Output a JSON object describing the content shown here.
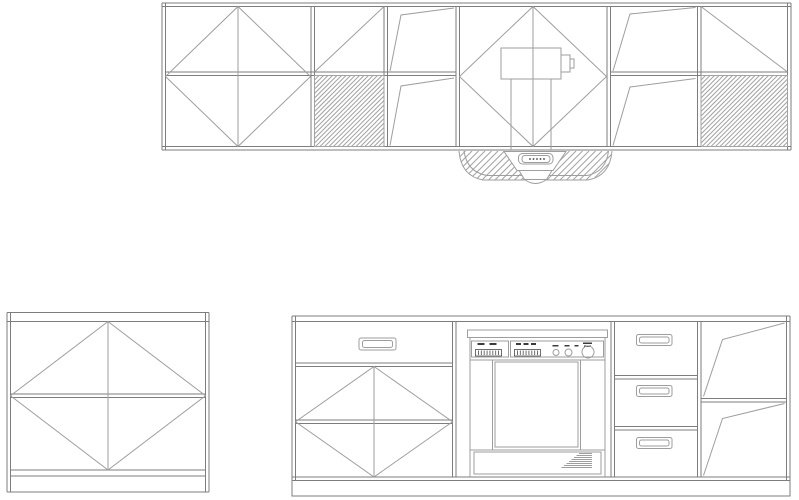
{
  "canvas": {
    "width": 799,
    "height": 500,
    "background": "#ffffff"
  },
  "colors": {
    "frame": "#7d7d7d",
    "line": "#9e9e9e",
    "hatch": "#a3a3a3",
    "dark": "#3c3c3c",
    "white": "#ffffff",
    "none": "none"
  },
  "drawings": [
    {
      "name": "wall-cabinet-run",
      "primitives": [
        {
          "t": "dline",
          "x1": 162,
          "y1": 3,
          "x2": 791,
          "y2": 3,
          "g": 3.5,
          "c": "frame"
        },
        {
          "t": "dline",
          "x1": 162,
          "y1": 146.5,
          "x2": 791,
          "y2": 146.5,
          "g": 3.5,
          "c": "frame"
        },
        {
          "t": "dline",
          "x1": 162,
          "y1": 3,
          "x2": 162,
          "y2": 150,
          "g": 3.5,
          "c": "frame"
        },
        {
          "t": "dline",
          "x1": 787.5,
          "y1": 3,
          "x2": 787.5,
          "y2": 150,
          "g": 3.5,
          "c": "frame"
        },
        {
          "t": "dline",
          "x1": 311,
          "y1": 6.5,
          "x2": 311,
          "y2": 146.5,
          "g": 3.5,
          "c": "frame",
          "name": "partition"
        },
        {
          "t": "dline",
          "x1": 384,
          "y1": 6.5,
          "x2": 384,
          "y2": 146.5,
          "g": 3.5,
          "c": "frame",
          "name": "partition"
        },
        {
          "t": "dline",
          "x1": 456,
          "y1": 6.5,
          "x2": 456,
          "y2": 146.5,
          "g": 3.5,
          "c": "frame",
          "name": "partition"
        },
        {
          "t": "dline",
          "x1": 607,
          "y1": 6.5,
          "x2": 607,
          "y2": 146.5,
          "g": 3.5,
          "c": "frame",
          "name": "partition"
        },
        {
          "t": "dline",
          "x1": 697.5,
          "y1": 6.5,
          "x2": 697.5,
          "y2": 146.5,
          "g": 3.5,
          "c": "frame",
          "name": "partition"
        },
        {
          "t": "dline",
          "x1": 165.5,
          "y1": 72,
          "x2": 456,
          "y2": 72,
          "g": 3.5,
          "c": "frame",
          "name": "mid-rail"
        },
        {
          "t": "dline",
          "x1": 610.5,
          "y1": 72,
          "x2": 787.5,
          "y2": 72,
          "g": 3.5,
          "c": "frame",
          "name": "mid-rail"
        },
        {
          "t": "diamond",
          "cx": 238,
          "cy": 76.5,
          "rx": 72.5,
          "ry": 70,
          "vline": true,
          "name": "door-diamond-symbol"
        },
        {
          "t": "line",
          "x1": 314.5,
          "y1": 72,
          "x2": 384,
          "y2": 6.5,
          "name": "door-diagonal-symbol"
        },
        {
          "t": "hatch",
          "x": 314.5,
          "y": 75.5,
          "w": 69.5,
          "h": 71,
          "s": 4.5,
          "name": "hatched-panel"
        },
        {
          "t": "poly",
          "pts": [
            [
              390,
              71
            ],
            [
              401,
              15
            ],
            [
              454,
              8
            ]
          ],
          "name": "door-swing-symbol"
        },
        {
          "t": "poly",
          "pts": [
            [
              390,
              145.5
            ],
            [
              401,
              86
            ],
            [
              454,
              78
            ]
          ],
          "name": "door-swing-symbol"
        },
        {
          "t": "diamond",
          "cx": 533,
          "cy": 76.5,
          "rx": 73.5,
          "ry": 70,
          "vline": true,
          "name": "door-diamond-symbol"
        },
        {
          "t": "rect",
          "x": 501,
          "y": 48,
          "w": 60,
          "h": 31,
          "name": "fan-unit"
        },
        {
          "t": "rect",
          "x": 561,
          "y": 55,
          "w": 9,
          "h": 17,
          "name": "fan-motor"
        },
        {
          "t": "rect",
          "x": 570,
          "y": 59,
          "w": 4,
          "h": 9
        },
        {
          "t": "line",
          "x1": 511,
          "y1": 79,
          "x2": 511,
          "y2": 150,
          "name": "duct-line"
        },
        {
          "t": "line",
          "x1": 551,
          "y1": 79,
          "x2": 551,
          "y2": 150,
          "name": "duct-line"
        },
        {
          "t": "poly",
          "pts": [
            [
              613,
              71
            ],
            [
              630,
              14
            ],
            [
              695.5,
              7.5
            ]
          ],
          "name": "door-swing-symbol"
        },
        {
          "t": "poly",
          "pts": [
            [
              613,
              145.5
            ],
            [
              630,
              87
            ],
            [
              695.5,
              78.5
            ]
          ],
          "name": "door-swing-symbol"
        },
        {
          "t": "line",
          "x1": 701,
          "y1": 6.5,
          "x2": 787.5,
          "y2": 72,
          "name": "door-diagonal-symbol"
        },
        {
          "t": "hatch",
          "x": 701,
          "y": 75.5,
          "w": 86.5,
          "h": 71,
          "s": 4.5,
          "name": "hatched-panel"
        }
      ]
    },
    {
      "name": "range-hood",
      "primitives": [
        {
          "t": "path",
          "d": "M 459 151 Q 461 176 483 180 L 588 180 Q 610 176 612 151",
          "f": "none",
          "name": "hood-outline"
        },
        {
          "t": "hatch",
          "x": 459,
          "y": 151,
          "w": 153,
          "h": 30,
          "s": 6.5,
          "clipd": "M 459 151 Q 461 176 483 180 L 588 180 Q 610 176 612 151 Z",
          "name": "hood-hatch"
        },
        {
          "t": "path",
          "d": "M 464 151 Q 467 172 487 175.5 L 587 175.5 Q 606 172 608.5 151",
          "f": "none"
        },
        {
          "t": "polygon",
          "pts": [
            [
              504,
              151.5
            ],
            [
              566,
              151.5
            ],
            [
              553,
              170.5
            ],
            [
              517,
              170.5
            ]
          ],
          "f": "white",
          "name": "hood-control-panel"
        },
        {
          "t": "rrect",
          "x": 518.5,
          "y": 153.5,
          "w": 34.5,
          "h": 10.5,
          "rx": 4,
          "f": "white",
          "name": "hood-control-pad"
        },
        {
          "t": "rrect",
          "x": 522,
          "y": 155.5,
          "w": 28,
          "h": 7,
          "rx": 3,
          "f": "white"
        },
        {
          "t": "dot",
          "x": 530,
          "y": 159,
          "r": 0.9,
          "name": "hood-button"
        },
        {
          "t": "dot",
          "x": 533.5,
          "y": 159,
          "r": 0.9,
          "name": "hood-button"
        },
        {
          "t": "dot",
          "x": 537,
          "y": 159,
          "r": 0.9,
          "name": "hood-button"
        },
        {
          "t": "dot",
          "x": 540.5,
          "y": 159,
          "r": 0.9,
          "name": "hood-button"
        },
        {
          "t": "dot",
          "x": 544,
          "y": 159,
          "r": 0.9,
          "name": "hood-button"
        },
        {
          "t": "polygon",
          "pts": [
            [
              519,
              170.5
            ],
            [
              552,
              170.5
            ],
            [
              546.5,
              179.5
            ],
            [
              524.5,
              179.5
            ]
          ],
          "f": "white",
          "name": "hood-lamp"
        },
        {
          "t": "path",
          "d": "M 524.5 179.5 Q 535.5 187.5 546.5 179.5 Z",
          "f": "white"
        }
      ]
    },
    {
      "name": "base-cabinet-single",
      "primitives": [
        {
          "t": "dline",
          "x1": 7,
          "y1": 312.5,
          "x2": 7,
          "y2": 492,
          "g": 3.5,
          "c": "frame"
        },
        {
          "t": "dline",
          "x1": 205.5,
          "y1": 312.5,
          "x2": 205.5,
          "y2": 492,
          "g": 3.5,
          "c": "frame"
        },
        {
          "t": "dline",
          "x1": 7,
          "y1": 312.5,
          "x2": 209,
          "y2": 312.5,
          "g": 9,
          "c": "frame",
          "name": "top-rail"
        },
        {
          "t": "dline",
          "x1": 10.5,
          "y1": 394,
          "x2": 205.5,
          "y2": 394,
          "g": 3.5,
          "c": "frame",
          "name": "mid-rail"
        },
        {
          "t": "dline",
          "x1": 10.5,
          "y1": 470,
          "x2": 205.5,
          "y2": 470,
          "g": 6,
          "c": "frame",
          "name": "bottom-rail"
        },
        {
          "t": "line",
          "x1": 7,
          "y1": 492,
          "x2": 209,
          "y2": 492,
          "c": "frame",
          "name": "plinth-line"
        },
        {
          "t": "diamond",
          "cx": 108,
          "cy": 395.75,
          "rx": 97.5,
          "ry": 74.25,
          "vline": true,
          "name": "door-diamond-symbol"
        }
      ]
    },
    {
      "name": "base-cabinet-run",
      "primitives": [
        {
          "t": "dline",
          "x1": 292,
          "y1": 316,
          "x2": 790,
          "y2": 316,
          "g": 5.5,
          "c": "frame",
          "name": "top-rail"
        },
        {
          "t": "dline",
          "x1": 292,
          "y1": 477,
          "x2": 790,
          "y2": 477,
          "g": 3.5,
          "c": "frame",
          "name": "bottom-rail"
        },
        {
          "t": "dline",
          "x1": 292,
          "y1": 316,
          "x2": 292,
          "y2": 480.5,
          "g": 3.5,
          "c": "frame"
        },
        {
          "t": "dline",
          "x1": 786.5,
          "y1": 316,
          "x2": 786.5,
          "y2": 480.5,
          "g": 3.5,
          "c": "frame"
        },
        {
          "t": "rect",
          "x": 292,
          "y": 480.5,
          "w": 498,
          "h": 15.5,
          "c": "frame",
          "name": "plinth"
        },
        {
          "t": "dline",
          "x1": 452.5,
          "y1": 321.5,
          "x2": 452.5,
          "y2": 477,
          "g": 3.5,
          "c": "frame",
          "name": "partition"
        },
        {
          "t": "dline",
          "x1": 611,
          "y1": 321.5,
          "x2": 611,
          "y2": 477,
          "g": 3.5,
          "c": "frame",
          "name": "partition"
        },
        {
          "t": "dline",
          "x1": 697.5,
          "y1": 321.5,
          "x2": 697.5,
          "y2": 477,
          "g": 3.5,
          "c": "frame",
          "name": "partition"
        },
        {
          "t": "dline",
          "x1": 295.5,
          "y1": 363,
          "x2": 452.5,
          "y2": 363,
          "g": 3.5,
          "c": "frame",
          "name": "drawer-rail"
        },
        {
          "t": "rrect",
          "x": 359,
          "y": 338,
          "w": 37,
          "h": 12,
          "rx": 2,
          "name": "drawer-handle"
        },
        {
          "t": "rrect",
          "x": 362.5,
          "y": 340.5,
          "w": 30,
          "h": 7,
          "rx": 2
        },
        {
          "t": "dline",
          "x1": 295.5,
          "y1": 420,
          "x2": 452.5,
          "y2": 420,
          "g": 3.5,
          "c": "frame",
          "name": "mid-rail"
        },
        {
          "t": "diamond",
          "cx": 374,
          "cy": 421.75,
          "rx": 78.5,
          "ry": 55.25,
          "vline": true,
          "name": "door-diamond-symbol"
        },
        {
          "t": "rect",
          "x": 467.5,
          "y": 330,
          "w": 140,
          "h": 7.5,
          "name": "dishwasher-trim"
        },
        {
          "t": "line",
          "x1": 470,
          "y1": 337.5,
          "x2": 470,
          "y2": 477,
          "name": "dishwasher-side"
        },
        {
          "t": "line",
          "x1": 605,
          "y1": 337.5,
          "x2": 605,
          "y2": 477,
          "name": "dishwasher-side"
        },
        {
          "t": "rect",
          "x": 471.5,
          "y": 341,
          "w": 37,
          "h": 16,
          "name": "dishwasher-control-left"
        },
        {
          "t": "rect",
          "x": 510.5,
          "y": 341,
          "w": 93,
          "h": 16,
          "name": "dishwasher-control-right"
        },
        {
          "t": "dash",
          "x": 477.5,
          "y": 343,
          "w": 7,
          "h": 2
        },
        {
          "t": "dash",
          "x": 489.5,
          "y": 343,
          "w": 7,
          "h": 2
        },
        {
          "t": "ticks",
          "x": 475.5,
          "y": 349.5,
          "w": 26,
          "h": 6.5,
          "n": 9,
          "name": "button-strip"
        },
        {
          "t": "dash",
          "x": 516,
          "y": 343,
          "w": 5,
          "h": 2
        },
        {
          "t": "dash",
          "x": 523.5,
          "y": 343,
          "w": 5,
          "h": 2
        },
        {
          "t": "dash",
          "x": 531,
          "y": 343,
          "w": 5,
          "h": 2
        },
        {
          "t": "ticks",
          "x": 514.5,
          "y": 349.5,
          "w": 26,
          "h": 6.5,
          "n": 9,
          "name": "button-strip"
        },
        {
          "t": "dash",
          "x": 552.5,
          "y": 345,
          "w": 6,
          "h": 1.5
        },
        {
          "t": "dash",
          "x": 564.5,
          "y": 345,
          "w": 5,
          "h": 1.5
        },
        {
          "t": "dash",
          "x": 574.5,
          "y": 345,
          "w": 4,
          "h": 1.5
        },
        {
          "t": "dash",
          "x": 583,
          "y": 342.5,
          "w": 9,
          "h": 1.5
        },
        {
          "t": "dash",
          "x": 584,
          "y": 345.5,
          "w": 7,
          "h": 1.5
        },
        {
          "t": "circle",
          "cx": 556,
          "cy": 352.5,
          "r": 3,
          "name": "dishwasher-knob"
        },
        {
          "t": "circle",
          "cx": 568.5,
          "cy": 352.5,
          "r": 3.5,
          "name": "dishwasher-knob"
        },
        {
          "t": "circle",
          "cx": 588,
          "cy": 352,
          "r": 6,
          "name": "dishwasher-dial"
        },
        {
          "t": "rect",
          "x": 470,
          "y": 360,
          "w": 135,
          "h": 90,
          "name": "dishwasher-door"
        },
        {
          "t": "line",
          "x1": 492.5,
          "y1": 360,
          "x2": 492.5,
          "y2": 450
        },
        {
          "t": "line",
          "x1": 580.5,
          "y1": 360,
          "x2": 580.5,
          "y2": 450
        },
        {
          "t": "rect",
          "x": 495,
          "y": 362,
          "w": 83,
          "h": 85,
          "name": "dishwasher-door-panel"
        },
        {
          "t": "rect",
          "x": 474,
          "y": 452,
          "w": 127,
          "h": 22,
          "name": "dishwasher-kick"
        },
        {
          "t": "stair",
          "x2": 592,
          "y": 453.5,
          "n": 8,
          "dy": 2,
          "w0": 13,
          "dw": 2.5,
          "name": "vent-stair"
        },
        {
          "t": "dline",
          "x1": 614.5,
          "y1": 375.5,
          "x2": 697.5,
          "y2": 375.5,
          "g": 3.5,
          "c": "frame",
          "name": "drawer-rail"
        },
        {
          "t": "dline",
          "x1": 614.5,
          "y1": 426.5,
          "x2": 697.5,
          "y2": 426.5,
          "g": 3.5,
          "c": "frame",
          "name": "drawer-rail"
        },
        {
          "t": "rrect",
          "x": 636.5,
          "y": 334.5,
          "w": 35.5,
          "h": 11,
          "rx": 2,
          "name": "drawer-handle"
        },
        {
          "t": "rrect",
          "x": 639.5,
          "y": 337,
          "w": 29.5,
          "h": 6,
          "rx": 2
        },
        {
          "t": "rrect",
          "x": 636.5,
          "y": 385.5,
          "w": 35.5,
          "h": 11,
          "rx": 2,
          "name": "drawer-handle"
        },
        {
          "t": "rrect",
          "x": 639.5,
          "y": 388,
          "w": 29.5,
          "h": 6,
          "rx": 2
        },
        {
          "t": "rrect",
          "x": 636.5,
          "y": 437.5,
          "w": 35.5,
          "h": 11,
          "rx": 2,
          "name": "drawer-handle"
        },
        {
          "t": "rrect",
          "x": 639.5,
          "y": 440,
          "w": 29.5,
          "h": 6,
          "rx": 2
        },
        {
          "t": "dline",
          "x1": 701,
          "y1": 398.5,
          "x2": 786.5,
          "y2": 398.5,
          "g": 3.5,
          "c": "frame",
          "name": "mid-rail"
        },
        {
          "t": "poly",
          "pts": [
            [
              703.5,
              396.5
            ],
            [
              722.5,
              339.5
            ],
            [
              784.5,
              323
            ]
          ],
          "name": "door-swing-symbol"
        },
        {
          "t": "poly",
          "pts": [
            [
              703.5,
              475.5
            ],
            [
              722.5,
              418.5
            ],
            [
              784.5,
              403.5
            ]
          ],
          "name": "door-swing-symbol"
        }
      ]
    }
  ]
}
